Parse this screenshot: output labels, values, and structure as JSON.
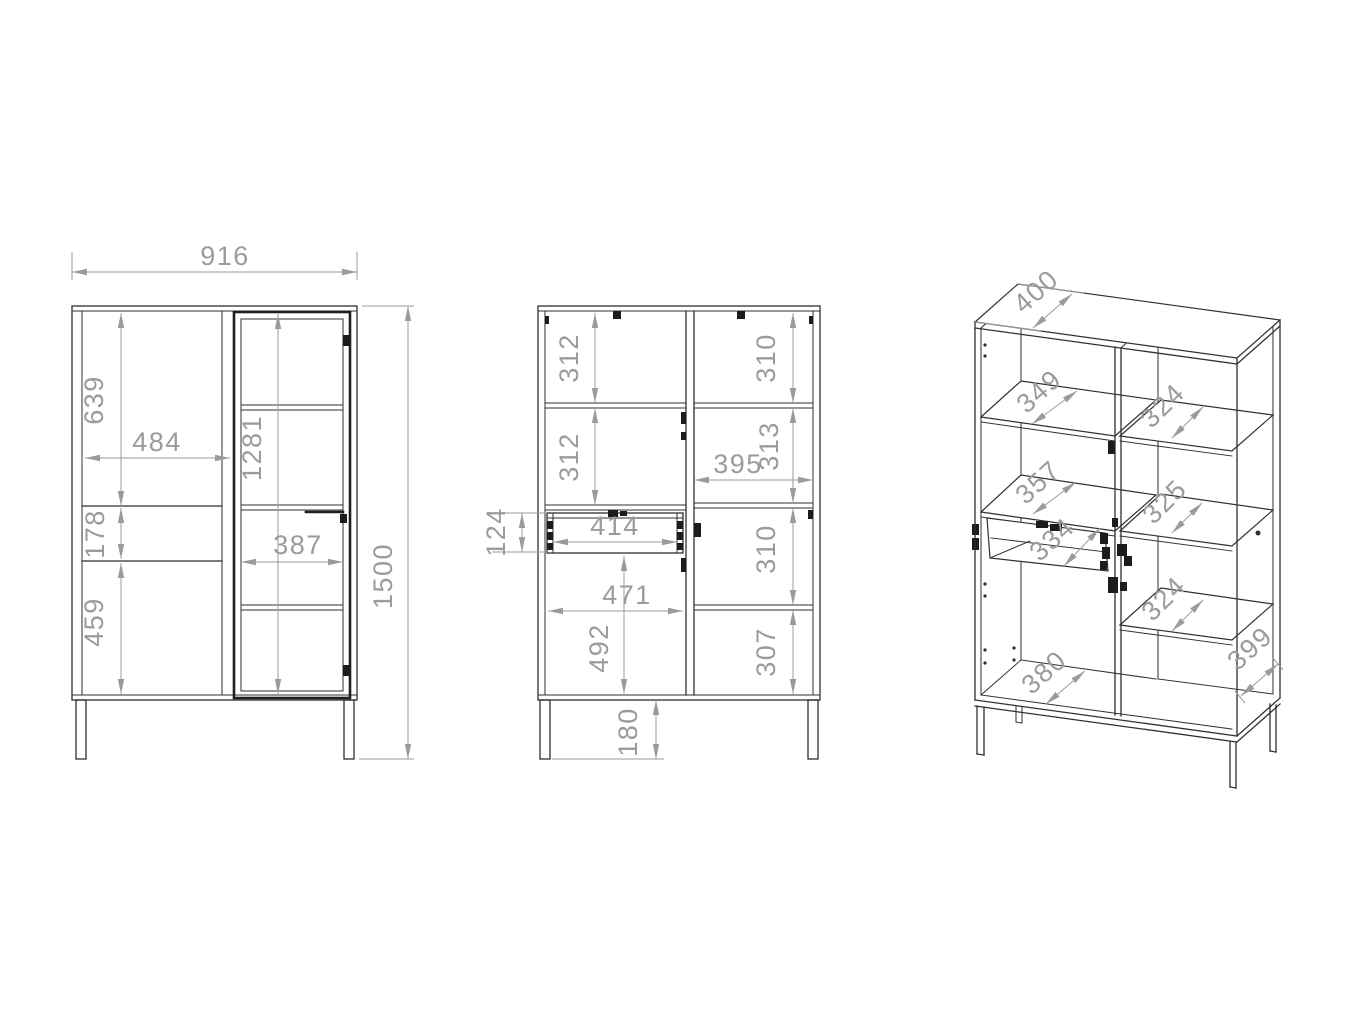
{
  "meta": {
    "title": "Display cabinet technical drawing, three views",
    "background": "#ffffff",
    "line_color": "#2f2f2f",
    "dimension_color": "#9b9b9b"
  },
  "front": {
    "dims": {
      "overall_width": "916",
      "overall_height": "1500",
      "upper_section": "639",
      "left_door_width": "484",
      "glass_door_height": "1281",
      "drawer_front": "178",
      "lower_section": "459",
      "glass_door_width": "387"
    }
  },
  "internal": {
    "dims": {
      "top_left": "312",
      "mid_left": "312",
      "top_right": "310",
      "mid_right": "313",
      "right_width": "395",
      "drawer_opening": "124",
      "drawer_width": "414",
      "left_width": "471",
      "lower_left": "492",
      "lower_right": "310",
      "bottom_right": "307",
      "leg_height": "180"
    }
  },
  "perspective": {
    "dims": {
      "top_depth": "400",
      "left_shelf_top": "349",
      "right_shelf_top": "324",
      "left_shelf_mid": "357",
      "right_shelf_mid": "325",
      "drawer_depth": "334",
      "right_shelf_low": "324",
      "bottom_depth": "380",
      "side_depth": "399"
    }
  }
}
